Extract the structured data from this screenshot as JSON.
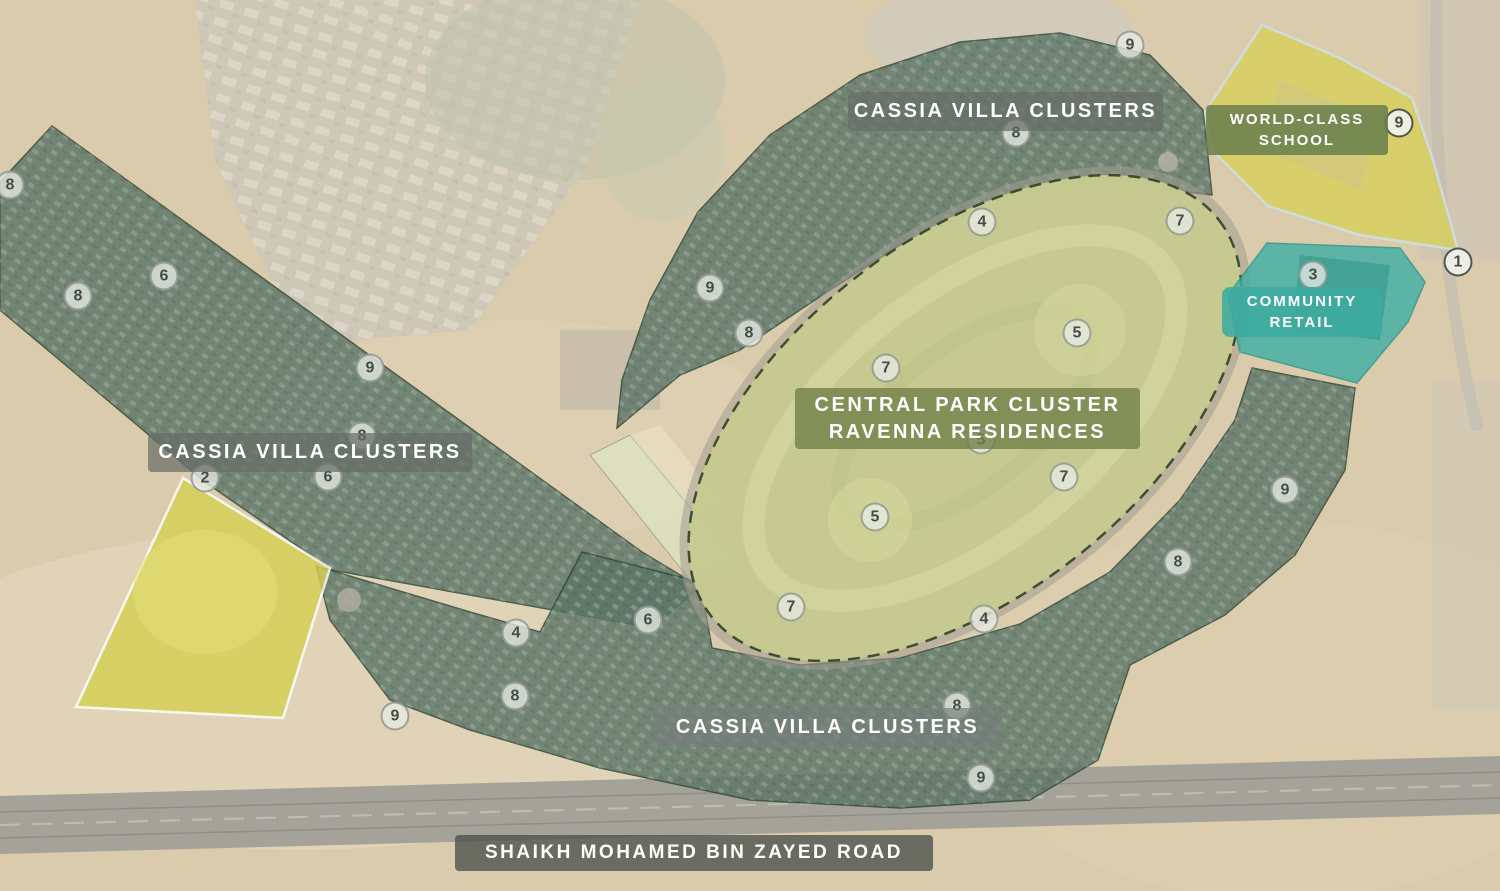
{
  "zones": {
    "villa_clusters": {
      "label": "CASSIA VILLA CLUSTERS",
      "occurrences": 3,
      "color": "#5c7668"
    },
    "central_park": {
      "label_line1": "CENTRAL PARK CLUSTER",
      "label_line2": "RAVENNA RESIDENCES",
      "color": "#c7cc90"
    },
    "school": {
      "label_line1": "WORLD-CLASS",
      "label_line2": "SCHOOL",
      "color": "#d8d05c"
    },
    "retail": {
      "label_line1": "COMMUNITY",
      "label_line2": "RETAIL",
      "color": "#3fb0a4"
    },
    "highway": {
      "label": "SHAIKH MOHAMED BIN ZAYED ROAD",
      "color": "#a5a29a"
    }
  },
  "colors": {
    "sand": "#dbcbad",
    "villa_cluster_fill": "#5c7668",
    "park_fill": "#c7cc90",
    "school_fill": "#d8d05c",
    "retail_fill": "#3fb0a4",
    "label_gray_band": "#676c67",
    "label_olive_band": "#717f47",
    "label_teal_band": "#3eab9f",
    "road_band": "#4e524e"
  },
  "markers": [
    {
      "n": "9",
      "x": 1130,
      "y": 45
    },
    {
      "n": "9",
      "x": 1399,
      "y": 123,
      "v": "dark"
    },
    {
      "n": "8",
      "x": 1016,
      "y": 133
    },
    {
      "n": "8",
      "x": 10,
      "y": 185
    },
    {
      "n": "7",
      "x": 1180,
      "y": 221
    },
    {
      "n": "4",
      "x": 982,
      "y": 222
    },
    {
      "n": "1",
      "x": 1458,
      "y": 262,
      "v": "dark"
    },
    {
      "n": "3",
      "x": 1313,
      "y": 275
    },
    {
      "n": "6",
      "x": 164,
      "y": 276
    },
    {
      "n": "9",
      "x": 710,
      "y": 288
    },
    {
      "n": "8",
      "x": 78,
      "y": 296
    },
    {
      "n": "5",
      "x": 1077,
      "y": 333
    },
    {
      "n": "8",
      "x": 749,
      "y": 333
    },
    {
      "n": "7",
      "x": 886,
      "y": 368
    },
    {
      "n": "9",
      "x": 370,
      "y": 368
    },
    {
      "n": "8",
      "x": 362,
      "y": 436
    },
    {
      "n": "5",
      "x": 981,
      "y": 440
    },
    {
      "n": "7",
      "x": 1064,
      "y": 477
    },
    {
      "n": "2",
      "x": 205,
      "y": 478
    },
    {
      "n": "6",
      "x": 328,
      "y": 477
    },
    {
      "n": "9",
      "x": 1285,
      "y": 490
    },
    {
      "n": "5",
      "x": 875,
      "y": 517
    },
    {
      "n": "8",
      "x": 1178,
      "y": 562
    },
    {
      "n": "7",
      "x": 791,
      "y": 607
    },
    {
      "n": "4",
      "x": 984,
      "y": 619
    },
    {
      "n": "6",
      "x": 648,
      "y": 620
    },
    {
      "n": "4",
      "x": 516,
      "y": 633
    },
    {
      "n": "8",
      "x": 515,
      "y": 696
    },
    {
      "n": "8",
      "x": 957,
      "y": 706
    },
    {
      "n": "9",
      "x": 395,
      "y": 716
    },
    {
      "n": "9",
      "x": 981,
      "y": 778
    }
  ]
}
